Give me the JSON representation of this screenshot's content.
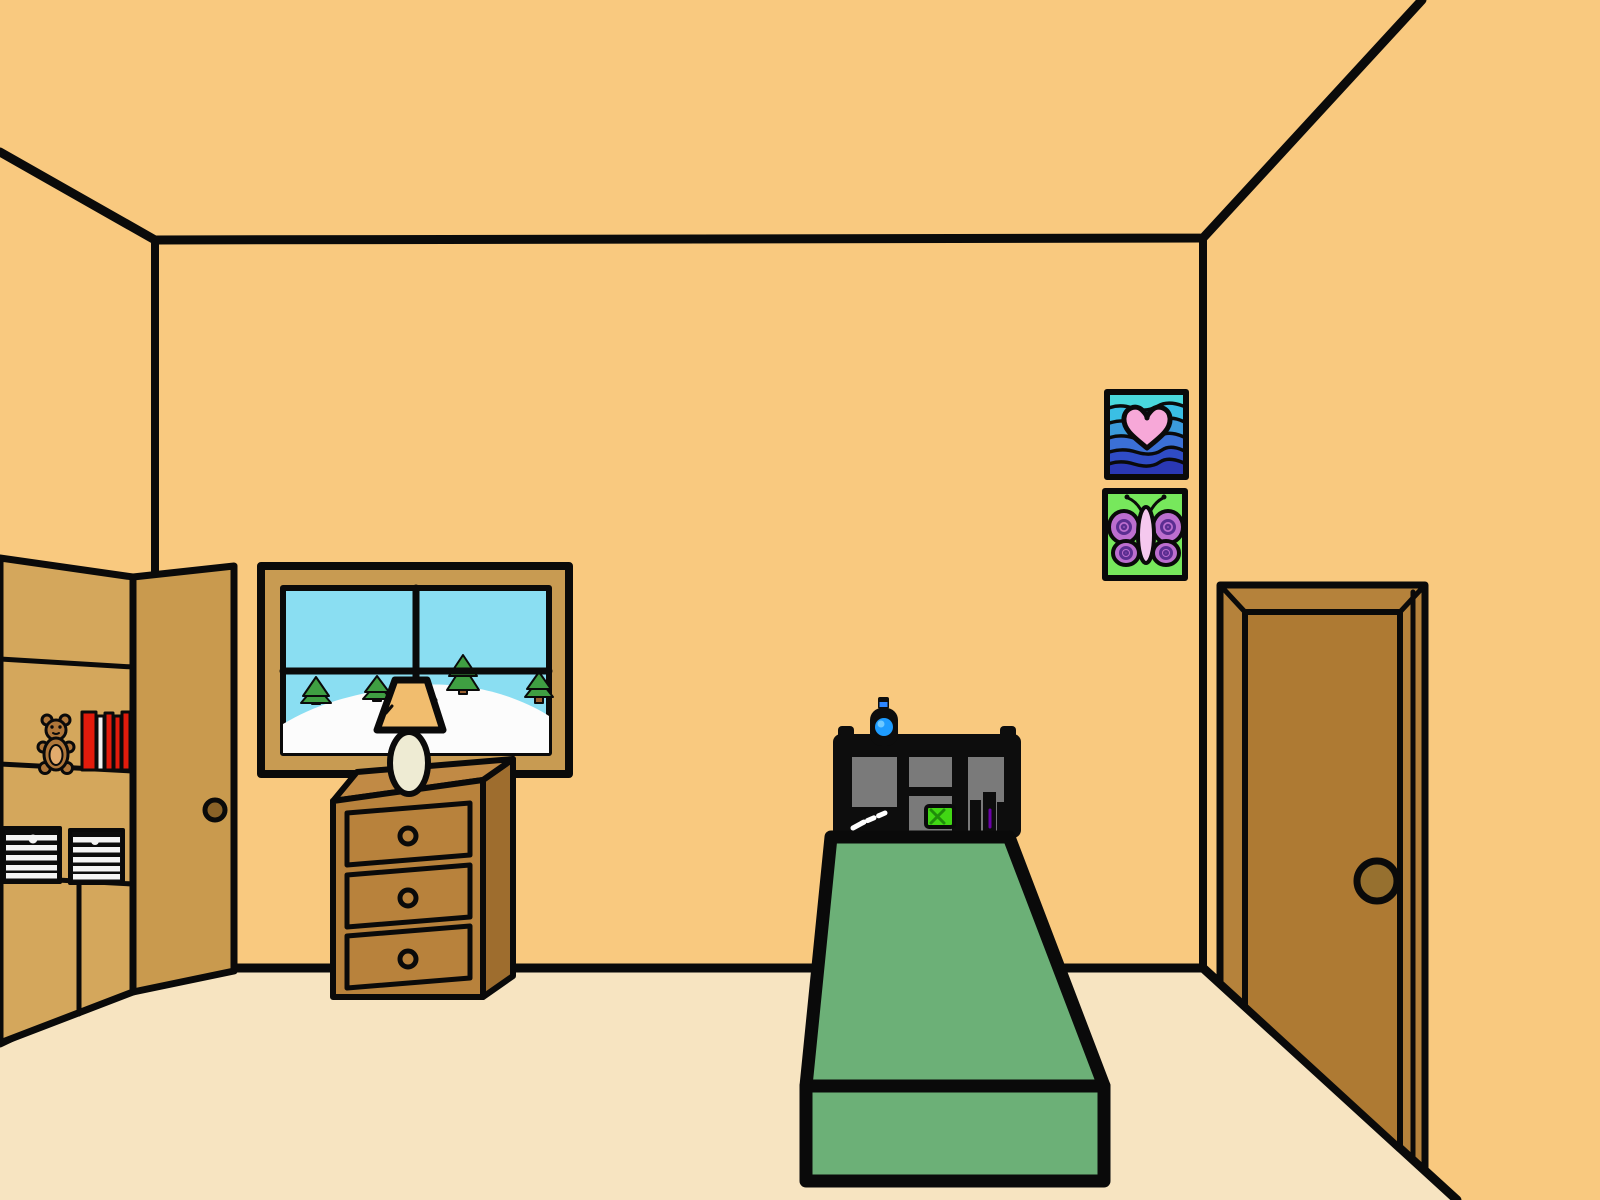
{
  "scene": {
    "width": 1600,
    "height": 1200,
    "description": "cartoon bedroom room-escape scene"
  },
  "colors": {
    "outline": "#0a0a0a",
    "wall": "#f9c97f",
    "floor": "#f7e4c1",
    "closet_interior": "#d4a75c",
    "closet_door": "#c99a4e",
    "closet_door_knob": "#8a6228",
    "bear_fur": "#b0773a",
    "bear_belly": "#e2ab6d",
    "book_red": "#e21b0c",
    "book_pale": "#f2f2f2",
    "crate_black": "#0d0d0d",
    "crate_stripe": "#f5f5f5",
    "window_frame": "#c89b52",
    "sky": "#8adef2",
    "snow": "#fcfcfc",
    "tree_green": "#3f9f42",
    "tree_trunk": "#9b5f2f",
    "lamp_shade": "#f1bd6e",
    "lamp_base": "#eeebd3",
    "dresser_front": "#b8823c",
    "dresser_side": "#9e6d2e",
    "dresser_top": "#c18a45",
    "headboard_black": "#0d0d0d",
    "cubby_gray": "#7a7a7a",
    "knife_white": "#ffffff",
    "chest_green": "#41d714",
    "chest_detail": "#1f8c0a",
    "potion_band": "#2e86ff",
    "potion_blue": "#1e9cff",
    "potion_glow": "#6ec9ff",
    "shelf_item_purple": "#6a00a8",
    "blanket_green": "#6cb077",
    "wave_top": "#49d8dc",
    "wave_2": "#3abfe4",
    "wave_3": "#3b9bdc",
    "wave_4": "#3b70d6",
    "wave_5": "#2f4cc6",
    "wave_6": "#2a38b4",
    "heart_pink": "#f7a8d8",
    "butterfly_bg": "#77e85c",
    "butterfly_wing": "#bc6ecf",
    "butterfly_swirl": "#5b2e91",
    "butterfly_body": "#f5c8ee",
    "exit_door_frame": "#b5823b",
    "exit_door_panel": "#ae7a33",
    "exit_door_knob": "#96702f"
  },
  "objects": {
    "room": "bedroom walls and floor",
    "closet": "open closet with shelves",
    "closet_door": "open closet door",
    "teddy_bear": "teddy bear on shelf",
    "books": "row of books on shelf",
    "crate_left": "striped crate left",
    "crate_right": "striped crate right",
    "window": "window with winter scene",
    "lamp": "table lamp",
    "dresser": "three drawer dresser",
    "drawer_1": "top drawer",
    "drawer_2": "middle drawer",
    "drawer_3": "bottom drawer",
    "bed": "bed with green blanket",
    "headboard": "black cubby headboard",
    "potion_bottle": "blue potion bottle on headboard",
    "knife": "knife in cubby",
    "treasure_chest": "green chest in cubby",
    "purple_item": "purple item in cubby",
    "picture_heart": "heart over waves picture",
    "picture_butterfly": "butterfly picture",
    "exit_door": "exit door",
    "exit_door_knob": "exit door knob"
  }
}
